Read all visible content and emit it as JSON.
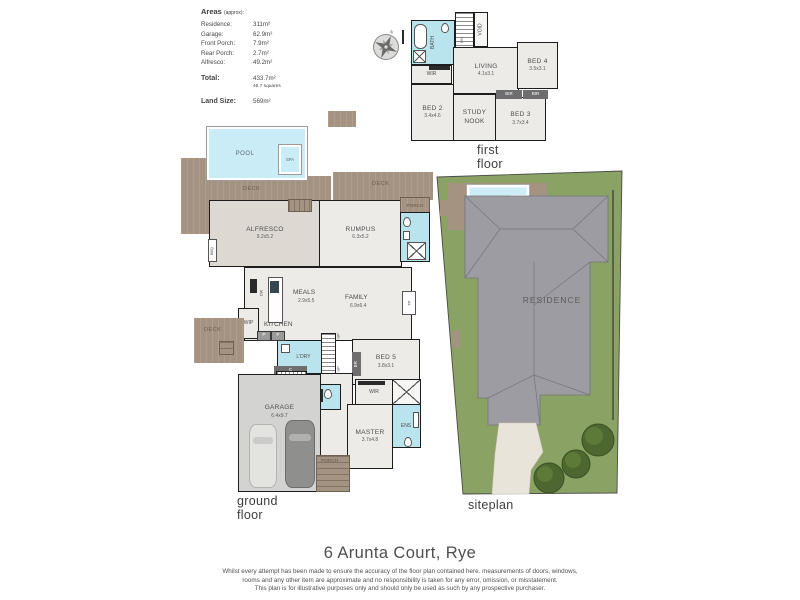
{
  "areas_panel": {
    "title": "Areas",
    "approx": "(approx):",
    "rows": [
      {
        "label": "Residence:",
        "value": "311m²"
      },
      {
        "label": "Garage:",
        "value": "62.9m²"
      },
      {
        "label": "Front Porch:",
        "value": "7.9m²"
      },
      {
        "label": "Rear Porch:",
        "value": "2.7m²"
      },
      {
        "label": "Alfresco:",
        "value": "49.2m²"
      }
    ],
    "total_label": "Total:",
    "total_value": "433.7m²",
    "total_squares": "46.7 squares",
    "land_label": "Land Size:",
    "land_value": "569m²"
  },
  "compass": {
    "north": "N"
  },
  "first_floor": {
    "caption": "first floor",
    "bath": "BATH",
    "void": "VOID",
    "dn": "DN",
    "wir": "WIR",
    "living": {
      "name": "LIVING",
      "dims": "4.1x3.1"
    },
    "bed4": {
      "name": "BED 4",
      "dims": "3.5x3.1"
    },
    "bed2": {
      "name": "BED 2",
      "dims": "3.4x4.6"
    },
    "study": {
      "line1": "STUDY",
      "line2": "NOOK"
    },
    "bed3": {
      "name": "BED 3",
      "dims": "3.7x3.4"
    },
    "bir": "BIR"
  },
  "ground_floor": {
    "caption": "ground floor",
    "pool": "POOL",
    "spa": "SPA",
    "deck": "DECK",
    "porch": "PORCH",
    "bbq": "BBQ",
    "alfresco": {
      "name": "ALFRESCO",
      "dims": "9.2x5.2"
    },
    "rumpus": {
      "name": "RUMPUS",
      "dims": "6.3x5.2"
    },
    "meals": {
      "name": "MEALS",
      "dims": "2.9x5.5"
    },
    "family": {
      "name": "FAMILY",
      "dims": "6.9x6.4"
    },
    "kitchen": "KITCHEN",
    "wip": "WIP",
    "dw": "DW",
    "fp": "FP",
    "ldry": "L'DRY",
    "c": "C",
    "p": "P",
    "f": "F",
    "up": "UP",
    "br": "BR",
    "bed5": {
      "name": "BED 5",
      "dims": "3.8x3.1"
    },
    "garage": {
      "name": "GARAGE",
      "dims": "6.4x9.7"
    },
    "wir": "WIR",
    "ens": "ENS",
    "master": {
      "name": "MASTER",
      "dims": "3.7x4.8"
    }
  },
  "siteplan": {
    "caption": "siteplan",
    "pool": "POOL",
    "spa": "SPA",
    "residence": "RESIDENCE"
  },
  "footer": {
    "address": "6 Arunta Court, Rye",
    "disclaimer": [
      "Whilst every attempt has been made to ensure the accuracy of the floor plan contained here. measurements of doors, windows,",
      "rooms and any other item are approximate and no responsibility is taken for any error, omission, or misstatement.",
      "This plan is for illustrative purposes only and should only be used as such by any prospective purchaser."
    ]
  },
  "colors": {
    "deck": "#a59382",
    "pool": "#c9ecf6",
    "wet_area": "#b9e4ee",
    "grass": "#8aa364",
    "roof": "#9c9ca2",
    "tree": "#4e6630",
    "wall": "#1d1d1d"
  }
}
